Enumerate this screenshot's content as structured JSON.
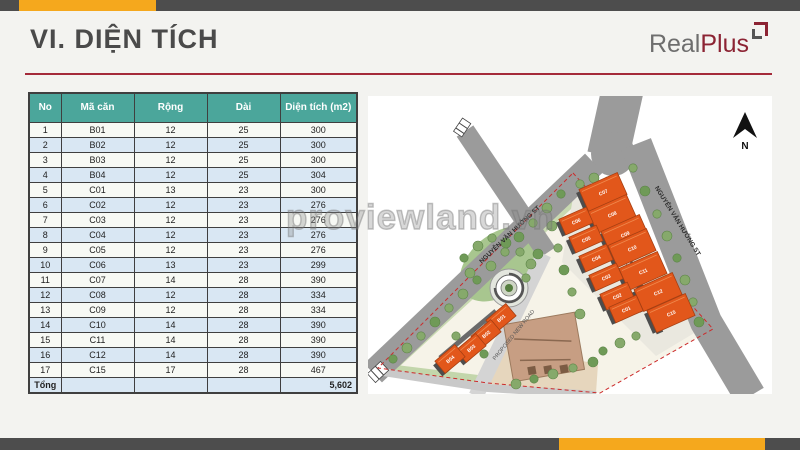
{
  "title": "VI. DIỆN TÍCH",
  "logo": {
    "real": "Real",
    "plus": "Plus"
  },
  "watermark": "proviewland.vn",
  "table": {
    "headers": [
      "No",
      "Mã căn",
      "Rộng",
      "Dài",
      "Diện tích (m2)"
    ],
    "rows": [
      [
        "1",
        "B01",
        "12",
        "25",
        "300"
      ],
      [
        "2",
        "B02",
        "12",
        "25",
        "300"
      ],
      [
        "3",
        "B03",
        "12",
        "25",
        "300"
      ],
      [
        "4",
        "B04",
        "12",
        "25",
        "304"
      ],
      [
        "5",
        "C01",
        "13",
        "23",
        "300"
      ],
      [
        "6",
        "C02",
        "12",
        "23",
        "276"
      ],
      [
        "7",
        "C03",
        "12",
        "23",
        "276"
      ],
      [
        "8",
        "C04",
        "12",
        "23",
        "276"
      ],
      [
        "9",
        "C05",
        "12",
        "23",
        "276"
      ],
      [
        "10",
        "C06",
        "13",
        "23",
        "299"
      ],
      [
        "11",
        "C07",
        "14",
        "28",
        "390"
      ],
      [
        "12",
        "C08",
        "12",
        "28",
        "334"
      ],
      [
        "13",
        "C09",
        "12",
        "28",
        "334"
      ],
      [
        "14",
        "C10",
        "14",
        "28",
        "390"
      ],
      [
        "15",
        "C11",
        "14",
        "28",
        "390"
      ],
      [
        "16",
        "C12",
        "14",
        "28",
        "390"
      ],
      [
        "17",
        "C15",
        "17",
        "28",
        "467"
      ]
    ],
    "total_label": "Tổng",
    "total_value": "5,602"
  },
  "map": {
    "north_label": "N",
    "road_left": "NGUYỄN VĂN HƯỞNG ST",
    "road_right": "NGUYỄN VĂN HƯỞNG ST",
    "road_proposed": "PROPOSED NEW ROAD",
    "buildings_b": [
      "B01",
      "B02",
      "B03",
      "B04"
    ],
    "buildings_c_left": [
      "C06",
      "C05",
      "C04",
      "C03",
      "C02",
      "C01"
    ],
    "buildings_c_right": [
      "C07",
      "C08",
      "C09",
      "C10",
      "C11",
      "C12",
      "C15"
    ]
  },
  "colors": {
    "accent_orange": "#F5A81D",
    "bar_gray": "#4D4D4D",
    "underline_red": "#A42A3A",
    "logo_red": "#8C2333",
    "table_header_teal": "#4BA69B",
    "row_alt_blue": "#D9E7F3",
    "building_orange": "#E2571B",
    "road_gray": "#9B9B9B"
  }
}
